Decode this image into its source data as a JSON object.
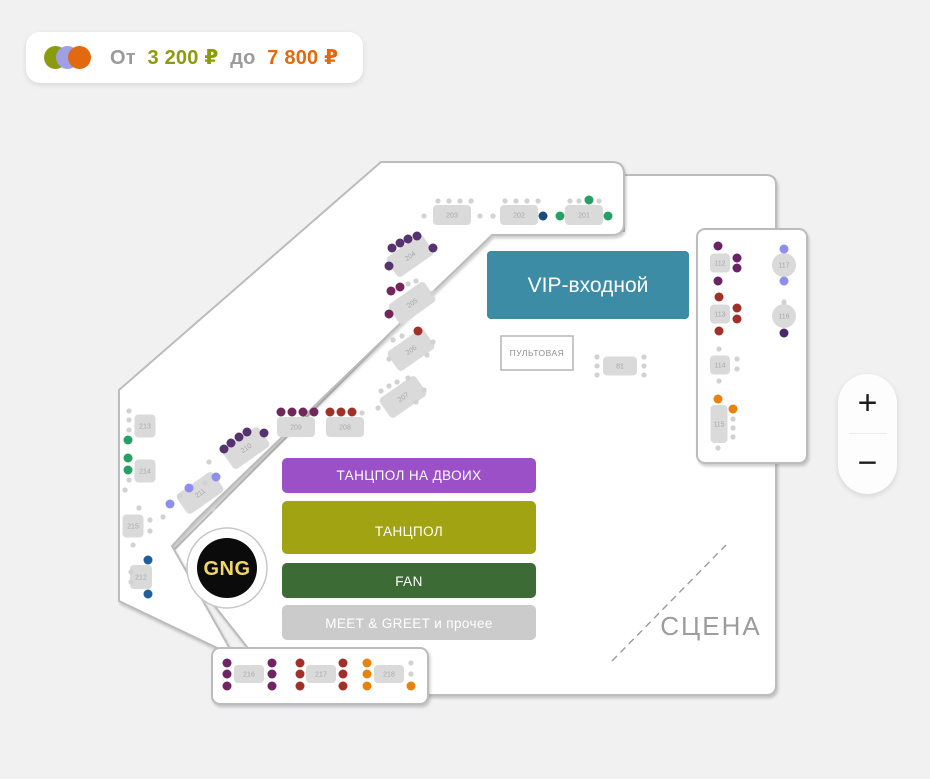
{
  "price_badge": {
    "from_label": "От",
    "from_value": "3 200 ₽",
    "to_label": "до",
    "to_value": "7 800 ₽",
    "dot_colors": {
      "olive": "#8a9c0e",
      "periwinkle": "#9f9fe8",
      "orange": "#e2690e"
    }
  },
  "zoom_controls": {
    "zoom_in": "+",
    "zoom_out": "−"
  },
  "map": {
    "logo_monogram": "GNG",
    "zones": {
      "vip": {
        "label": "VIP-входной",
        "color": "#3b8ca4"
      },
      "soundboard": {
        "label": "ПУЛЬТОВАЯ"
      },
      "dance_duo": {
        "label": "ТАНЦПОЛ НА ДВОИХ",
        "color": "#9b50c8"
      },
      "dance": {
        "label": "ТАНЦПОЛ",
        "color": "#a2a313"
      },
      "fan": {
        "label": "FAN",
        "color": "#3d6b35"
      },
      "meet_greet": {
        "label": "MEET & GREET и прочее",
        "color": "#cbcbcb"
      },
      "stage": {
        "label": "СЦЕНА"
      }
    },
    "seat_colors": {
      "green": "#27a163",
      "navy": "#1c4a7e",
      "blue": "#1f5f9e",
      "violet": "#55336f",
      "plum": "#71275a",
      "plum2": "#6e2562",
      "purple": "#6a2366",
      "red": "#a13028",
      "orange": "#e6820e",
      "peri": "#8e8eef",
      "darkviolet": "#46296b",
      "g": "#d2d2d2"
    },
    "tables": [
      {
        "label": "203",
        "x": 452,
        "y": 215,
        "w": 38,
        "h": 20,
        "seats": [
          [
            438,
            201,
            "g"
          ],
          [
            449,
            201,
            "g"
          ],
          [
            460,
            201,
            "g"
          ],
          [
            471,
            201,
            "g"
          ],
          [
            424,
            216,
            "g"
          ],
          [
            480,
            216,
            "g"
          ]
        ]
      },
      {
        "label": "202",
        "x": 519,
        "y": 215,
        "w": 38,
        "h": 20,
        "seats": [
          [
            505,
            201,
            "g"
          ],
          [
            516,
            201,
            "g"
          ],
          [
            527,
            201,
            "g"
          ],
          [
            538,
            201,
            "g"
          ],
          [
            493,
            216,
            "g"
          ],
          [
            543,
            216,
            "navy"
          ]
        ]
      },
      {
        "label": "201",
        "x": 584,
        "y": 215,
        "w": 38,
        "h": 20,
        "seats": [
          [
            570,
            201,
            "g"
          ],
          [
            579,
            201,
            "g"
          ],
          [
            589,
            200,
            "green"
          ],
          [
            599,
            201,
            "g"
          ],
          [
            560,
            216,
            "green"
          ],
          [
            608,
            216,
            "green"
          ]
        ]
      },
      {
        "label": "204",
        "x": 410,
        "y": 256,
        "w": 44,
        "h": 24,
        "rot": -35,
        "seats": [
          [
            392,
            248,
            "violet"
          ],
          [
            400,
            243,
            "violet"
          ],
          [
            408,
            239,
            "violet"
          ],
          [
            417,
            236,
            "violet"
          ],
          [
            433,
            248,
            "violet"
          ],
          [
            389,
            266,
            "violet"
          ]
        ]
      },
      {
        "label": "205",
        "x": 412,
        "y": 303,
        "w": 44,
        "h": 24,
        "rot": -35,
        "seats": [
          [
            391,
            291,
            "plum"
          ],
          [
            400,
            287,
            "plum"
          ],
          [
            408,
            284,
            "g"
          ],
          [
            416,
            281,
            "g"
          ],
          [
            433,
            293,
            "g"
          ],
          [
            389,
            314,
            "plum"
          ]
        ]
      },
      {
        "label": "206",
        "x": 411,
        "y": 350,
        "w": 44,
        "h": 24,
        "rot": -35,
        "seats": [
          [
            393,
            340,
            "g"
          ],
          [
            402,
            336,
            "g"
          ],
          [
            418,
            331,
            "red"
          ],
          [
            433,
            342,
            "g"
          ],
          [
            389,
            359,
            "g"
          ],
          [
            427,
            355,
            "g"
          ]
        ]
      },
      {
        "label": "207",
        "x": 403,
        "y": 397,
        "w": 44,
        "h": 24,
        "rot": -35,
        "seats": [
          [
            381,
            391,
            "g"
          ],
          [
            389,
            386,
            "g"
          ],
          [
            397,
            382,
            "g"
          ],
          [
            408,
            378,
            "g"
          ],
          [
            424,
            390,
            "g"
          ],
          [
            378,
            408,
            "g"
          ],
          [
            416,
            402,
            "g"
          ]
        ]
      },
      {
        "label": "209",
        "x": 296,
        "y": 427,
        "w": 38,
        "h": 20,
        "seats": [
          [
            281,
            412,
            "plum"
          ],
          [
            292,
            412,
            "plum"
          ],
          [
            303,
            412,
            "plum"
          ],
          [
            314,
            412,
            "plum"
          ]
        ]
      },
      {
        "label": "208",
        "x": 345,
        "y": 427,
        "w": 38,
        "h": 20,
        "seats": [
          [
            330,
            412,
            "red"
          ],
          [
            341,
            412,
            "red"
          ],
          [
            352,
            412,
            "red"
          ],
          [
            362,
            413,
            "g"
          ]
        ]
      },
      {
        "label": "210",
        "x": 246,
        "y": 448,
        "w": 44,
        "h": 24,
        "rot": -35,
        "seats": [
          [
            224,
            449,
            "violet"
          ],
          [
            231,
            443,
            "violet"
          ],
          [
            239,
            437,
            "violet"
          ],
          [
            247,
            432,
            "violet"
          ],
          [
            264,
            433,
            "violet"
          ],
          [
            209,
            462,
            "g"
          ]
        ]
      },
      {
        "label": "211",
        "x": 200,
        "y": 493,
        "w": 44,
        "h": 24,
        "rot": -35,
        "seats": [
          [
            170,
            504,
            "peri"
          ],
          [
            180,
            496,
            "g"
          ],
          [
            189,
            488,
            "peri"
          ],
          [
            205,
            483,
            "g"
          ],
          [
            216,
            477,
            "peri"
          ],
          [
            163,
            517,
            "g"
          ],
          [
            213,
            509,
            "g"
          ]
        ]
      },
      {
        "label": "213",
        "x": 145,
        "y": 426,
        "w": 21,
        "h": 23,
        "seats": [
          [
            129,
            411,
            "g"
          ],
          [
            129,
            420,
            "g"
          ],
          [
            129,
            430,
            "g"
          ],
          [
            128,
            440,
            "green"
          ]
        ]
      },
      {
        "label": "214",
        "x": 145,
        "y": 471,
        "w": 21,
        "h": 23,
        "seats": [
          [
            128,
            458,
            "green"
          ],
          [
            128,
            470,
            "green"
          ],
          [
            129,
            480,
            "g"
          ],
          [
            125,
            490,
            "g"
          ]
        ]
      },
      {
        "label": "215",
        "x": 133,
        "y": 526,
        "w": 21,
        "h": 23,
        "seats": [
          [
            139,
            508,
            "g"
          ],
          [
            150,
            520,
            "g"
          ],
          [
            150,
            531,
            "g"
          ],
          [
            133,
            545,
            "g"
          ]
        ]
      },
      {
        "label": "212",
        "x": 141,
        "y": 577,
        "w": 22,
        "h": 24,
        "seats": [
          [
            148,
            560,
            "blue"
          ],
          [
            131,
            572,
            "g"
          ],
          [
            131,
            582,
            "g"
          ],
          [
            148,
            594,
            "blue"
          ]
        ]
      },
      {
        "label": "81",
        "x": 620,
        "y": 366,
        "w": 34,
        "h": 19,
        "seats": [
          [
            597,
            357,
            "g"
          ],
          [
            597,
            366,
            "g"
          ],
          [
            597,
            375,
            "g"
          ],
          [
            644,
            357,
            "g"
          ],
          [
            644,
            366,
            "g"
          ],
          [
            644,
            375,
            "g"
          ]
        ]
      },
      {
        "label": "112",
        "x": 720,
        "y": 263,
        "w": 20,
        "h": 19,
        "seats": [
          [
            718,
            246,
            "purple"
          ],
          [
            737,
            258,
            "purple"
          ],
          [
            737,
            268,
            "purple"
          ],
          [
            718,
            281,
            "purple"
          ]
        ]
      },
      {
        "label": "113",
        "x": 720,
        "y": 314,
        "w": 20,
        "h": 19,
        "seats": [
          [
            719,
            297,
            "red"
          ],
          [
            737,
            308,
            "red"
          ],
          [
            737,
            319,
            "red"
          ],
          [
            719,
            331,
            "red"
          ]
        ]
      },
      {
        "label": "114",
        "x": 720,
        "y": 365,
        "w": 20,
        "h": 19,
        "seats": [
          [
            719,
            349,
            "g"
          ],
          [
            737,
            359,
            "g"
          ],
          [
            737,
            369,
            "g"
          ],
          [
            719,
            381,
            "g"
          ]
        ]
      },
      {
        "label": "115",
        "x": 719,
        "y": 424,
        "w": 17,
        "h": 38,
        "seats": [
          [
            718,
            399,
            "orange"
          ],
          [
            733,
            409,
            "orange"
          ],
          [
            733,
            419,
            "g"
          ],
          [
            733,
            428,
            "g"
          ],
          [
            733,
            437,
            "g"
          ],
          [
            718,
            448,
            "g"
          ]
        ]
      },
      {
        "label": "117",
        "x": 784,
        "y": 265,
        "shape": "circle",
        "r": 12,
        "seats": [
          [
            784,
            249,
            "peri"
          ],
          [
            784,
            281,
            "peri"
          ]
        ]
      },
      {
        "label": "116",
        "x": 784,
        "y": 316,
        "shape": "circle",
        "r": 12,
        "seats": [
          [
            784,
            302,
            "g"
          ],
          [
            784,
            333,
            "darkviolet"
          ]
        ]
      },
      {
        "label": "216",
        "x": 249,
        "y": 674,
        "w": 30,
        "h": 18,
        "seats": [
          [
            227,
            663,
            "plum2"
          ],
          [
            227,
            674,
            "plum2"
          ],
          [
            227,
            686,
            "plum2"
          ],
          [
            272,
            663,
            "plum2"
          ],
          [
            272,
            674,
            "plum2"
          ],
          [
            272,
            686,
            "plum2"
          ]
        ]
      },
      {
        "label": "217",
        "x": 321,
        "y": 674,
        "w": 30,
        "h": 18,
        "seats": [
          [
            300,
            663,
            "red"
          ],
          [
            300,
            674,
            "red"
          ],
          [
            300,
            686,
            "red"
          ],
          [
            343,
            663,
            "red"
          ],
          [
            343,
            674,
            "red"
          ],
          [
            343,
            686,
            "red"
          ]
        ]
      },
      {
        "label": "218",
        "x": 389,
        "y": 674,
        "w": 30,
        "h": 18,
        "seats": [
          [
            367,
            663,
            "orange"
          ],
          [
            367,
            674,
            "orange"
          ],
          [
            367,
            686,
            "orange"
          ],
          [
            411,
            663,
            "g"
          ],
          [
            411,
            674,
            "g"
          ],
          [
            411,
            686,
            "orange"
          ]
        ]
      }
    ]
  }
}
